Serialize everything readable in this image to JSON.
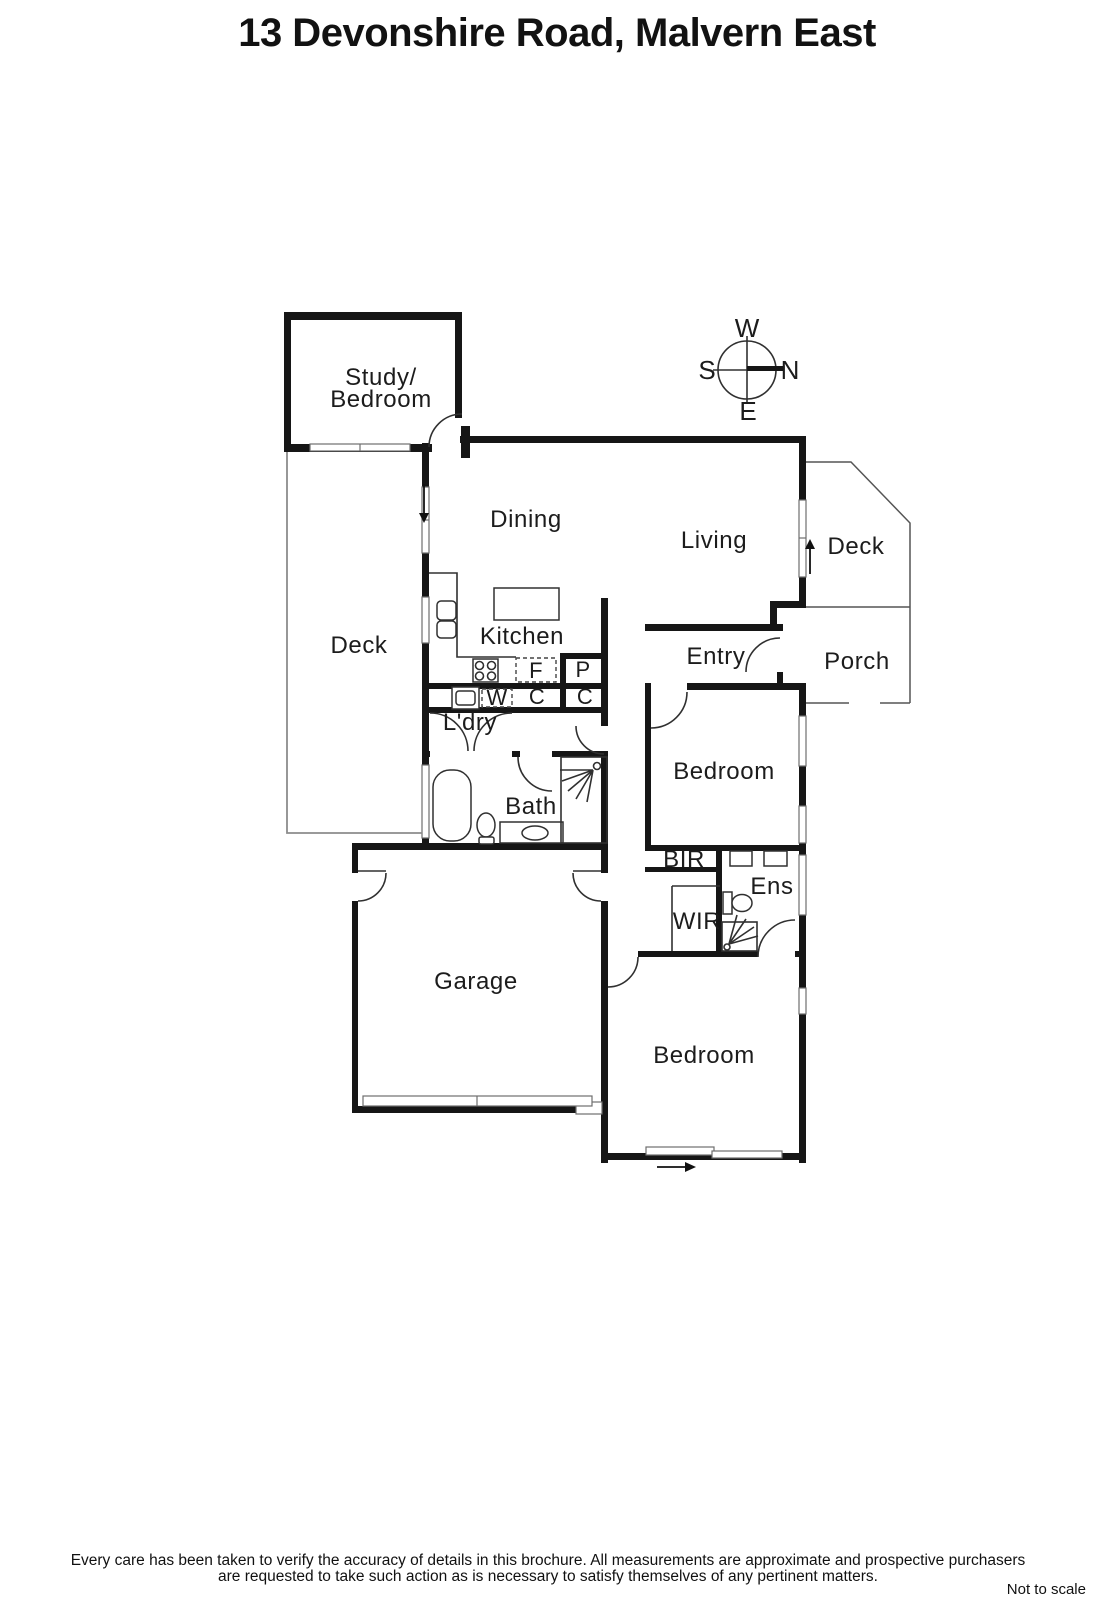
{
  "title": "13 Devonshire Road, Malvern East",
  "compass": {
    "north": "N",
    "south": "S",
    "east": "E",
    "west": "W"
  },
  "rooms": {
    "study_line1": "Study/",
    "study_line2": "Bedroom",
    "dining": "Dining",
    "living": "Living",
    "deck_right": "Deck",
    "deck_left": "Deck",
    "porch": "Porch",
    "kitchen": "Kitchen",
    "entry": "Entry",
    "laundry": "L'dry",
    "bath": "Bath",
    "bedroom_middle": "Bedroom",
    "bedroom_rear": "Bedroom",
    "garage": "Garage",
    "bir": "BIR",
    "wir": "WIR",
    "ensuite": "Ens"
  },
  "fixtures": {
    "fridge": "F",
    "pantry": "P",
    "washer": "W",
    "cupboard1": "C",
    "cupboard2": "C"
  },
  "footer": {
    "line1": "Every care has been taken to verify the accuracy of details in this brochure.  All measurements are approximate and prospective purchasers",
    "line2": "are requested to take such action as is necessary to satisfy themselves of any pertinent matters.",
    "scale_note": "Not to scale"
  },
  "colors": {
    "wall": "#161616",
    "line": "#303030",
    "background": "#ffffff"
  }
}
